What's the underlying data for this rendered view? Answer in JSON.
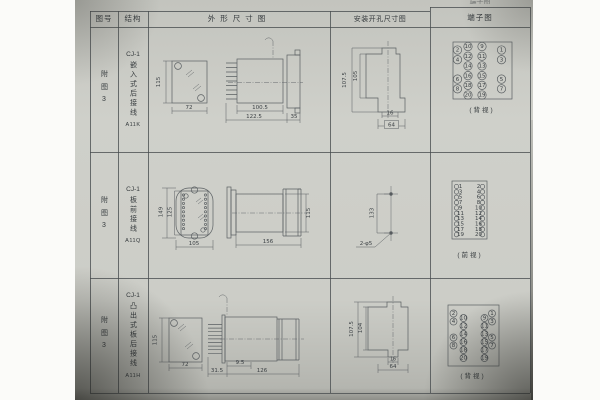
{
  "header": {
    "col_fig": "图号",
    "col_struct": "结构",
    "col_outline": "外形尺寸图",
    "col_mount": "安装开孔尺寸图",
    "col_terminal": "端子图",
    "top_partial": "端子图"
  },
  "rows": [
    {
      "fig": "附图3",
      "model": "CJ-1",
      "struct": "嵌入式后接线",
      "code": "A11K"
    },
    {
      "fig": "附图3",
      "model": "CJ-1",
      "struct": "板前接线",
      "code": "A11Q"
    },
    {
      "fig": "附图3",
      "model": "CJ-1",
      "struct": "凸出式板后接线",
      "code": "A11H"
    }
  ],
  "drawings": {
    "r1o": {
      "front_h": "115",
      "front_w": "72",
      "d1": "100.5",
      "d2": "122.5",
      "d3": "35"
    },
    "r1m": {
      "v1": "107.5",
      "v2": "105",
      "h1": "16",
      "h2": "64"
    },
    "r1t": {
      "label": "(背视)",
      "inner": [
        [
          10,
          9
        ],
        [
          12,
          11
        ],
        [
          14,
          13
        ],
        [
          16,
          15
        ],
        [
          18,
          17
        ],
        [
          20,
          19
        ]
      ],
      "outer": [
        [
          2,
          1
        ],
        [
          4,
          3
        ],
        [
          6,
          5
        ],
        [
          8,
          7
        ]
      ]
    },
    "r2o": {
      "v1": "149",
      "v2": "125",
      "w": "105",
      "d": "156",
      "h": "115"
    },
    "r2m": {
      "v": "133",
      "hole": "2-φ5"
    },
    "r2t": {
      "label": "(前视)",
      "left": [
        1,
        3,
        5,
        7,
        9,
        11,
        13,
        15,
        17,
        19
      ],
      "right": [
        2,
        4,
        6,
        8,
        10,
        12,
        14,
        16,
        18,
        20
      ]
    },
    "r3o": {
      "front_h": "115",
      "front_w": "72",
      "d1": "9.5",
      "d2": "31.5",
      "d3": "126"
    },
    "r3m": {
      "v1": "107.5",
      "v2": "104",
      "h1": "16",
      "h2": "64"
    },
    "r3t": {
      "label": "(背视)",
      "inner": [
        [
          10,
          9
        ],
        [
          12,
          11
        ],
        [
          14,
          13
        ],
        [
          16,
          15
        ],
        [
          18,
          17
        ],
        [
          20,
          19
        ]
      ],
      "outer": [
        [
          2,
          1
        ],
        [
          4,
          3
        ],
        [
          6,
          5
        ],
        [
          8,
          7
        ]
      ]
    }
  },
  "colors": {
    "paper": "#cdcec8",
    "line": "#5a5f62",
    "ink": "#363b3e"
  }
}
